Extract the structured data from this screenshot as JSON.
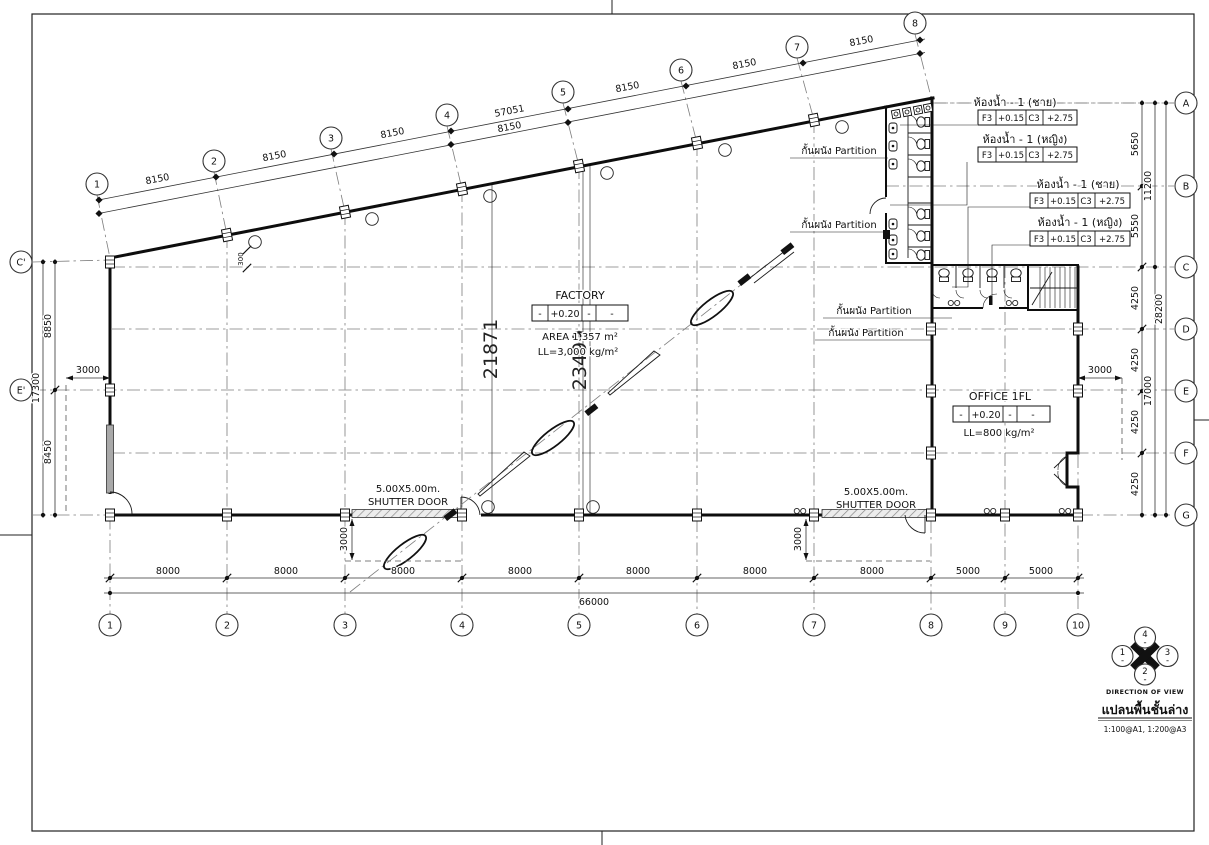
{
  "sheet": {
    "compass": {
      "top": "4",
      "left": "1",
      "right": "3",
      "bottom": "2",
      "dash": "-",
      "caption": "DIRECTION OF VIEW"
    },
    "title": "แปลนพื้นชั้นล่าง",
    "scale_note": "1:100@A1, 1:200@A3"
  },
  "grids": {
    "top_bubbles": [
      "1",
      "2",
      "3",
      "4",
      "5",
      "6",
      "7",
      "8"
    ],
    "bottom_bubbles": [
      "1",
      "2",
      "3",
      "4",
      "5",
      "6",
      "7",
      "8",
      "9",
      "10"
    ],
    "right_bubbles": [
      "A",
      "B",
      "C",
      "D",
      "E",
      "F",
      "G"
    ],
    "left_bubbles": [
      "C'",
      "E'"
    ]
  },
  "dims": {
    "top_segments": [
      "8150",
      "8150",
      "8150",
      "8150",
      "8150",
      "8150",
      "8150"
    ],
    "top_total": "57051",
    "bottom_segments": [
      "8000",
      "8000",
      "8000",
      "8000",
      "8000",
      "8000",
      "8000",
      "5000",
      "5000"
    ],
    "bottom_total": "66000",
    "right_segments": [
      "5650",
      "5550",
      "4250",
      "4250",
      "4250",
      "4250"
    ],
    "right_mid": [
      "11200",
      "17000"
    ],
    "right_total": "28200",
    "left_segments": [
      "8850",
      "8450"
    ],
    "left_total": "17300",
    "span_a": "21871",
    "span_b": "23499",
    "canopy_left": "3000",
    "canopy_right": "3000",
    "canopy_door1": "3000",
    "canopy_door2": "3000",
    "corner_offset": "300"
  },
  "labels": {
    "factory": {
      "name": "FACTORY",
      "level_cells": [
        "-",
        "+0.20",
        "-",
        "-"
      ],
      "area": "AREA 1,357 m²",
      "load": "LL=3,000 kg/m²"
    },
    "office": {
      "name": "OFFICE 1FL",
      "level_cells": [
        "-",
        "+0.20",
        "-",
        "-"
      ],
      "load": "LL=800 kg/m²"
    },
    "toilets": [
      {
        "title": "ห้องน้ำ - 1 (ชาย)",
        "cells": [
          "F3",
          "+0.15",
          "C3",
          "+2.75"
        ]
      },
      {
        "title": "ห้องน้ำ - 1 (หญิง)",
        "cells": [
          "F3",
          "+0.15",
          "C3",
          "+2.75"
        ]
      },
      {
        "title": "ห้องน้ำ - 1 (ชาย)",
        "cells": [
          "F3",
          "+0.15",
          "C3",
          "+2.75"
        ]
      },
      {
        "title": "ห้องน้ำ - 1 (หญิง)",
        "cells": [
          "F3",
          "+0.15",
          "C3",
          "+2.75"
        ]
      }
    ],
    "partition": "กั้นผนัง Partition",
    "shutter_door_line1": "5.00X5.00m.",
    "shutter_door_line2": "SHUTTER DOOR"
  }
}
